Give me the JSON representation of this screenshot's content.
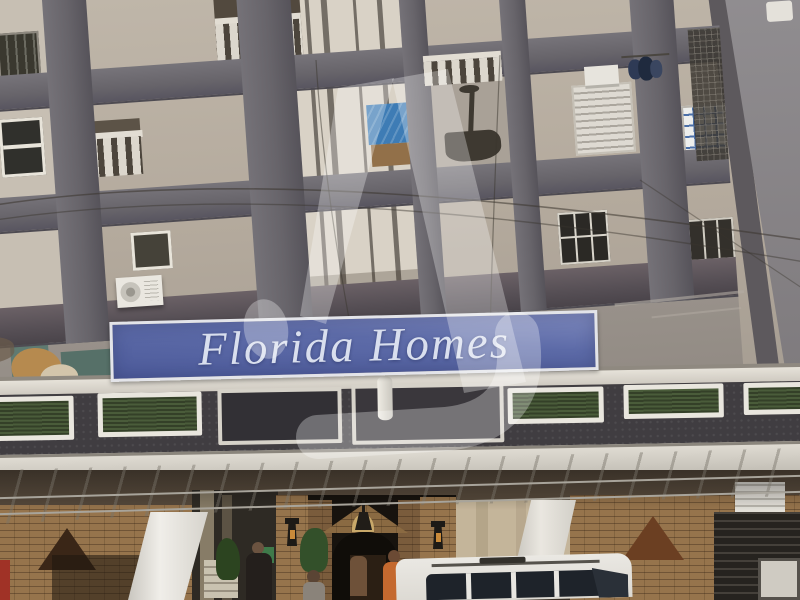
{
  "scene": {
    "type": "photograph",
    "subject": "Multi-storey apartment building facade with entrance, canopy and parked white van"
  },
  "sign": {
    "text": "Florida Homes"
  },
  "watermark": {
    "shape": "stylized-z-logo",
    "opacity": 0.3
  },
  "colors": {
    "sign_blue": "#5d6ba8",
    "sign_border": "#e3e4e9",
    "sign_text": "#d9dfee",
    "wall": "#b3a99c",
    "beam": "#67646a",
    "shaft": "#d9d2c6",
    "fascia": "#403d41",
    "panel_green": "#4a5c3a",
    "panel_border": "#e9e6de",
    "canopy": "#cdc9c0",
    "brick": "#96744c",
    "interior_dark": "#17130e",
    "tarp_blue": "#3e7cb5",
    "orange_shirt": "#c4692f",
    "van_white": "#eae8e3",
    "red_strip": "#a03226",
    "triangle_brown": "#3a2617"
  }
}
